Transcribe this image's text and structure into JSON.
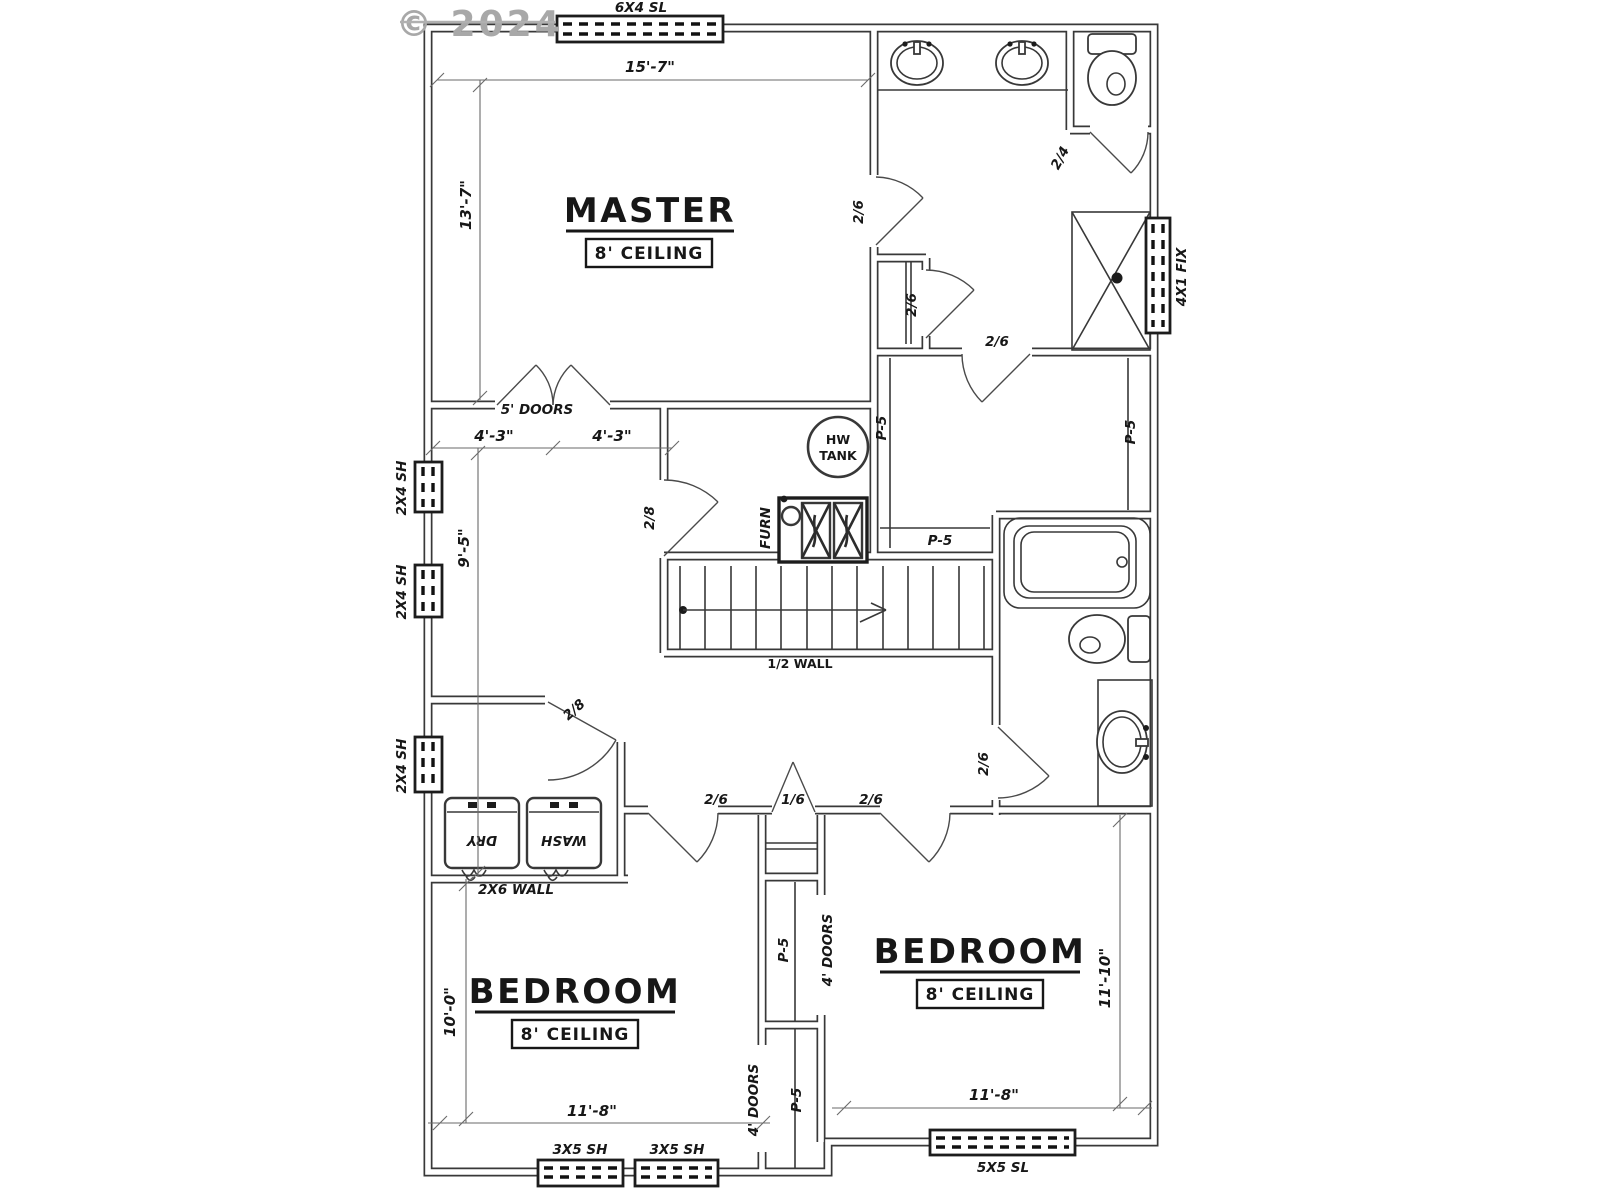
{
  "watermark": "© 2024",
  "rooms": {
    "master": {
      "title": "MASTER",
      "ceiling": "8' CEILING"
    },
    "bedroom1": {
      "title": "BEDROOM",
      "ceiling": "8' CEILING"
    },
    "bedroom2": {
      "title": "BEDROOM",
      "ceiling": "8' CEILING"
    }
  },
  "windows": {
    "top_slider": "6X4 SL",
    "right_fixed": "4X1 FIX",
    "left_sh1": "2X4 SH",
    "left_sh2": "2X4 SH",
    "left_sh3": "2X4 SH",
    "bottom_sh1": "3X5 SH",
    "bottom_sh2": "3X5 SH",
    "bottom_slider": "5X5 SL"
  },
  "doors": {
    "master_bath": "2/6",
    "master_closet": "2/6",
    "toilet_room": "2/4",
    "wic": "2/6",
    "mech": "2/8",
    "laundry": "2/8",
    "bedroom1": "2/6",
    "linen": "1/6",
    "bedroom2": "2/6",
    "bath2": "2/6",
    "master_french": "5' DOORS",
    "closet_bed1": "4' DOORS",
    "closet_bed2": "4' DOORS"
  },
  "closet_marks": {
    "wic_left": "P-5",
    "wic_right": "P-5",
    "wic_back": "P-5",
    "closet_upper": "P-5",
    "closet_lower": "P-5"
  },
  "labels": {
    "half_wall": "1/2 WALL",
    "wall_2x6": "2X6 WALL",
    "hw_line1": "HW",
    "hw_line2": "TANK",
    "furnace": "FURN",
    "washer": "WASH",
    "dryer": "DRY"
  },
  "dimensions": {
    "master_w": "15'-7\"",
    "master_h": "13'-7\"",
    "hall_a": "4'-3\"",
    "hall_b": "4'-3\"",
    "hall_h": "9'-5\"",
    "bed1_h": "10'-0\"",
    "bed1_w": "11'-8\"",
    "bed2_w": "11'-8\"",
    "bed2_h": "11'-10\""
  }
}
